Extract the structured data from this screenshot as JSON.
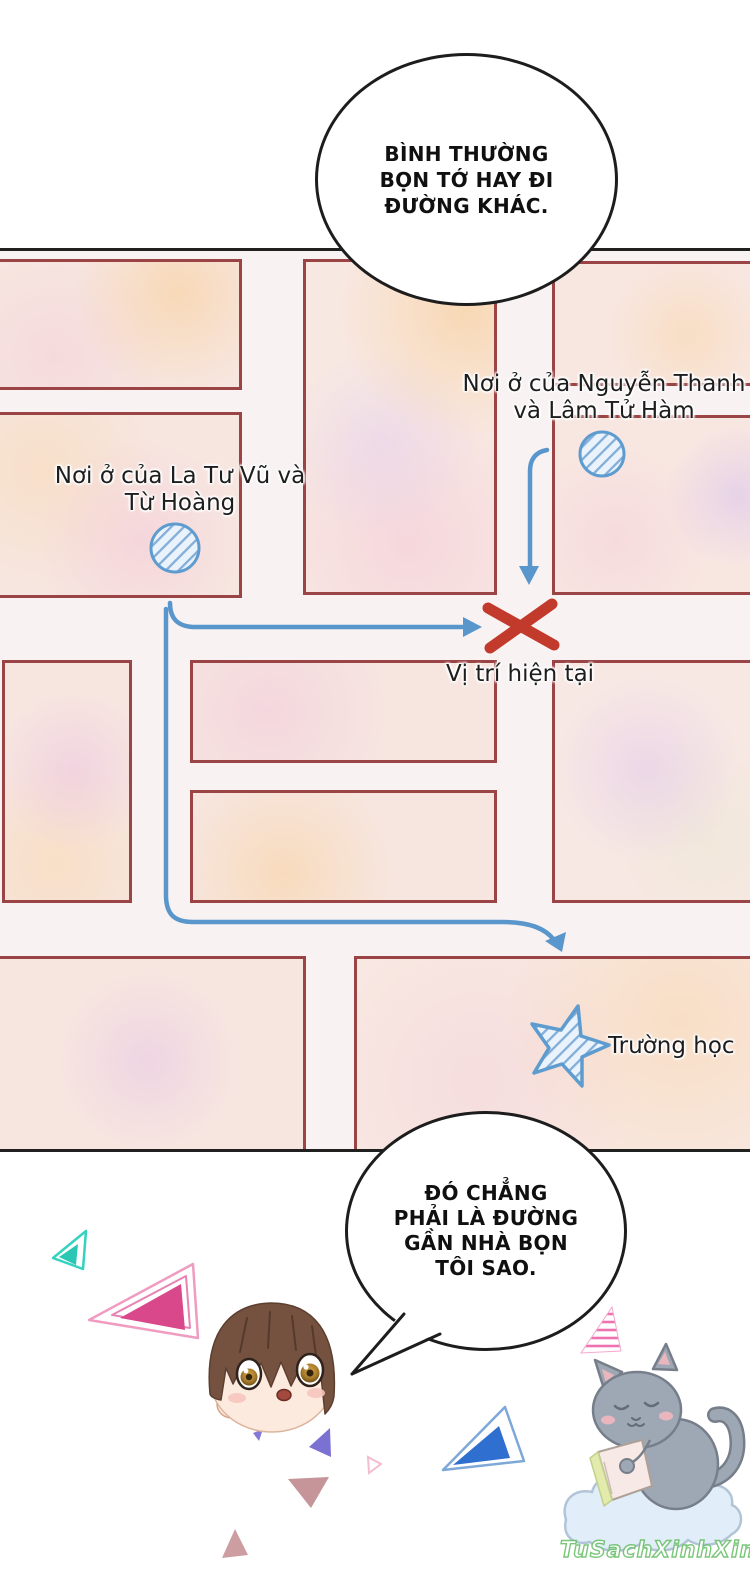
{
  "bubbles": {
    "top": {
      "lines": [
        "BÌNH THƯỜNG",
        "BỌN TỚ HAY ĐI",
        "ĐƯỜNG KHÁC."
      ]
    },
    "bottom": {
      "lines": [
        "ĐÓ CHẲNG",
        "PHẢI LÀ ĐƯỜNG",
        "GẦN NHÀ BỌN",
        "TÔI SAO."
      ]
    }
  },
  "map": {
    "labels": {
      "home_right_line1": "Nơi ở của Nguyễn Thanh",
      "home_right_line2": "và Lâm Tử Hàm",
      "home_left_line1": "Nơi ở của La Tư Vũ và",
      "home_left_line2": "Từ Hoàng",
      "current_position": "Vị trí hiện tại",
      "school": "Trường học"
    },
    "markers": {
      "home_left": "hatched-circle",
      "home_right": "hatched-circle",
      "school": "hatched-star",
      "current_position": "red-x"
    },
    "colors": {
      "road_line": "#9b4446",
      "road_fill": "#f8f2f3",
      "block_fill": "#f7e6e0",
      "route_blue": "#5996cc",
      "x_red": "#c23a2b",
      "marker_stroke": "#5e9ccf",
      "panel_border": "#202020"
    }
  },
  "decor": {
    "character": "chibi-boy-head",
    "mascot": "gray-cat-reading-on-cloud",
    "triangles": [
      "teal",
      "magenta",
      "pink-striped",
      "blue",
      "purple",
      "mauve"
    ]
  },
  "watermark": "TuSachXinhXinh"
}
